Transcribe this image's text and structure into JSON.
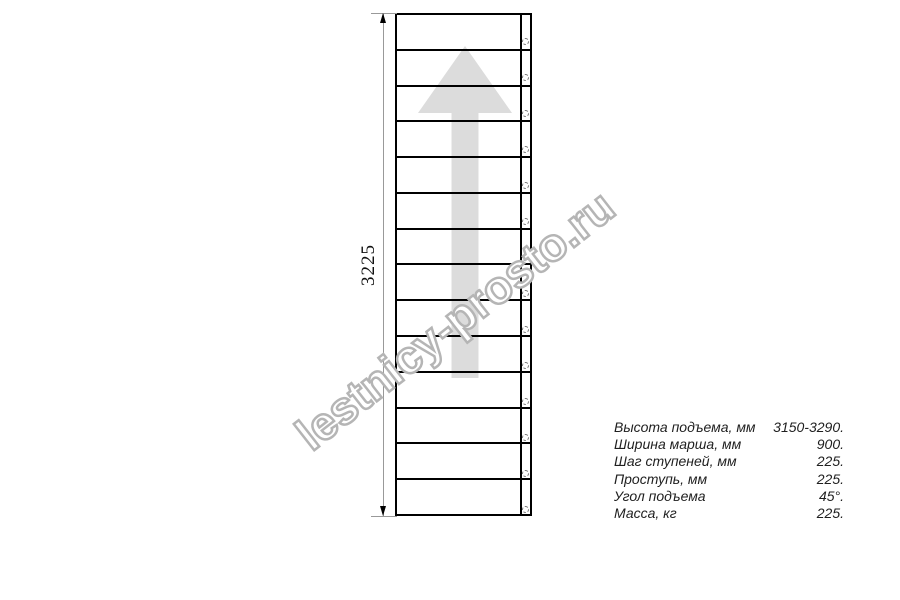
{
  "colors": {
    "line": "#000000",
    "dimension_line": "#999999",
    "arrow_fill": "#dcdcdc",
    "watermark_stroke": "#b5b5b5",
    "text": "#1f1f1f"
  },
  "drawing": {
    "steps_count": 14,
    "dimension_label": "3225",
    "arrow_direction": "up",
    "watermark": "lestnicy-prosto.ru"
  },
  "specs": {
    "rows": [
      {
        "label": "Высота подъема, мм",
        "value": "3150-3290."
      },
      {
        "label": "Ширина марша, мм",
        "value": "900."
      },
      {
        "label": "Шаг ступеней, мм",
        "value": "225."
      },
      {
        "label": "Проступь, мм",
        "value": "225."
      },
      {
        "label": "Угол подъема",
        "value": "45°."
      },
      {
        "label": "Масса, кг",
        "value": "225."
      }
    ]
  }
}
